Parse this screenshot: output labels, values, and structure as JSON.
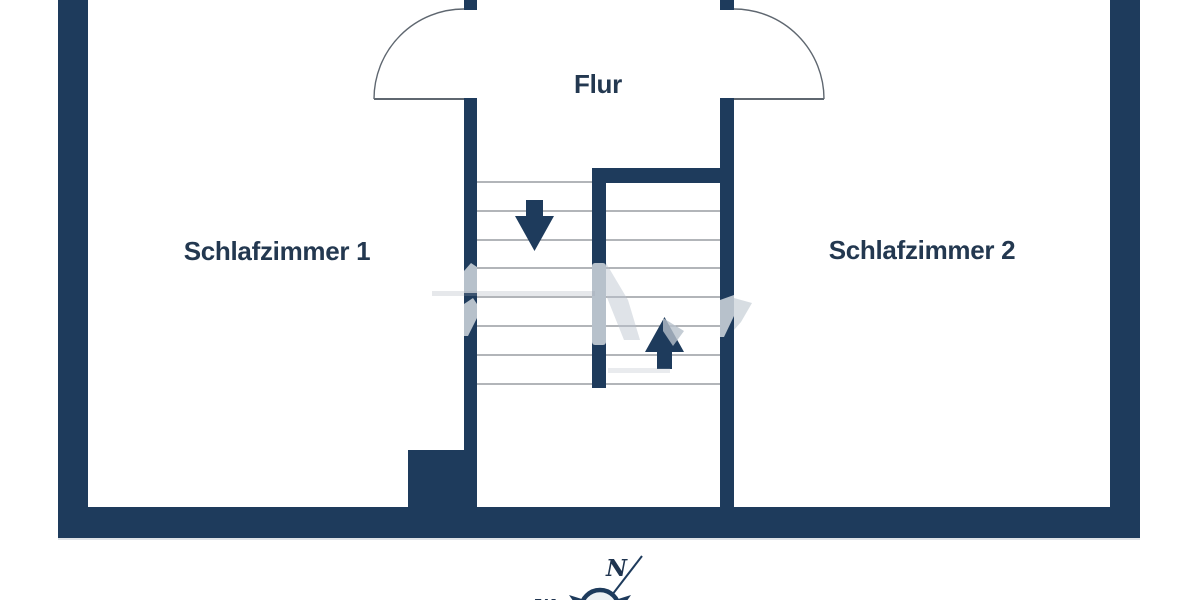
{
  "plan_type": "floor-plan",
  "rooms": {
    "bedroom1": {
      "label": "Schlafzimmer 1"
    },
    "bedroom2": {
      "label": "Schlafzimmer 2"
    },
    "hallway": {
      "label": "Flur"
    }
  },
  "stairs": {
    "left_flight_tread_count": 8,
    "right_flight_tread_count": 7,
    "arrows": [
      "down",
      "up"
    ]
  },
  "doors": {
    "count": 2,
    "type": "swing-arc-into-bedrooms"
  },
  "compass": {
    "north": "N",
    "west": "W"
  },
  "watermark": {
    "visible": true,
    "legible": false
  },
  "colors": {
    "wall": "#1e3b5c",
    "label_text": "#233850",
    "stair_tread_line": "#85898f",
    "door_swing_line": "#5f6770",
    "watermark": "#b7c1cb",
    "background": "#ffffff"
  }
}
